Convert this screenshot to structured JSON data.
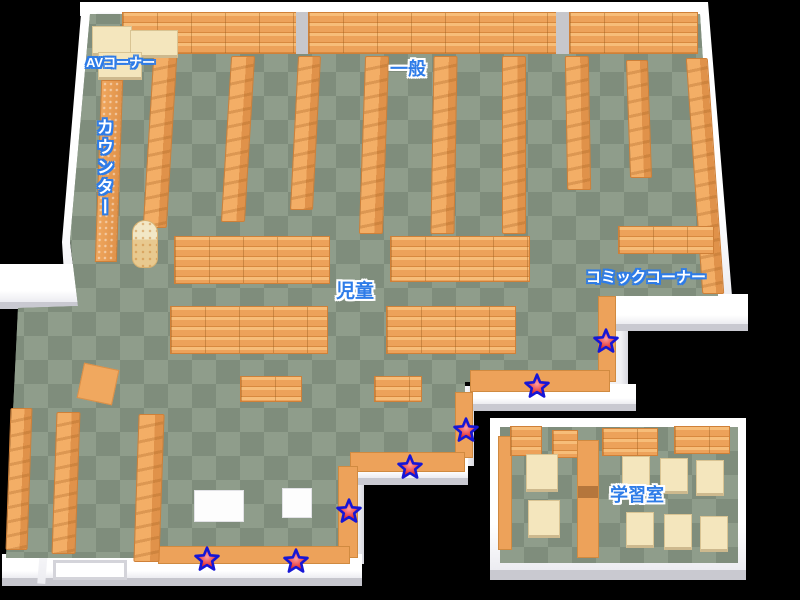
{
  "map": {
    "name": "library-floor-map",
    "labels": {
      "av_corner": "AVコーナー",
      "counter": "カウンター",
      "general": "一般",
      "children": "児童",
      "comic_corner": "コミックコーナー",
      "study_room": "学習室"
    },
    "markers": {
      "icon": "star-marker",
      "fill": "#e43131",
      "highlight": "#ff9d9d",
      "outline": "#1616d6",
      "positions": [
        {
          "x": 606,
          "y": 341
        },
        {
          "x": 537,
          "y": 386
        },
        {
          "x": 466,
          "y": 430
        },
        {
          "x": 410,
          "y": 467
        },
        {
          "x": 349,
          "y": 511
        },
        {
          "x": 296,
          "y": 561
        },
        {
          "x": 207,
          "y": 559
        }
      ]
    },
    "colors": {
      "floor_light": "#8f9d8b",
      "floor_dark": "#7f8d7c",
      "shelf_orange": "#eda25a",
      "desk_cream": "#f4e6bd",
      "wall_white": "#ffffff",
      "label_blue": "#2e7ce8",
      "background": "#000000"
    }
  }
}
